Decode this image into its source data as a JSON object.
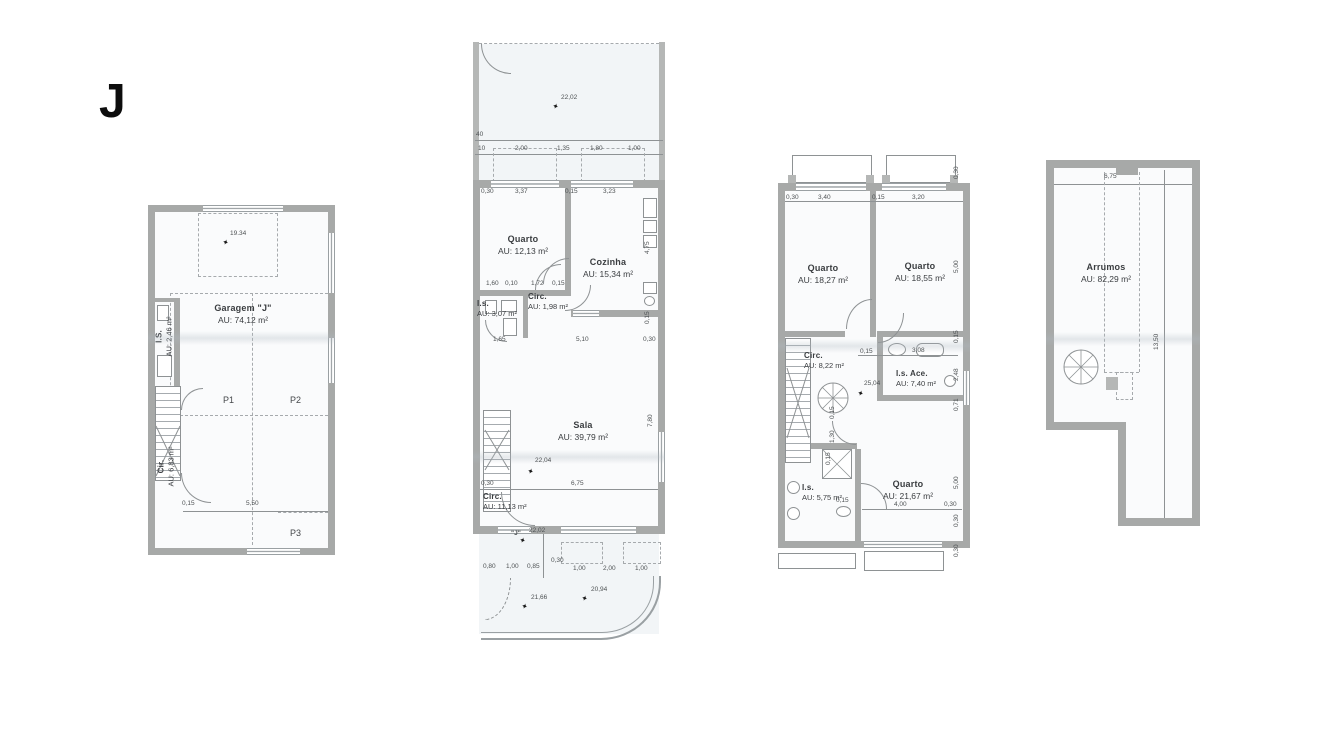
{
  "unit": {
    "letter": "J"
  },
  "garage": {
    "rooms": {
      "garagem": {
        "label": "Garagem \"J\"",
        "area": "AU: 74,12 m²"
      },
      "is": {
        "label": "I.S.",
        "area": "AU: 2,46 m²"
      },
      "cir": {
        "label": "Cir.",
        "area": "AU: 6,83 m²"
      }
    },
    "parking": {
      "p1": "P1",
      "p2": "P2",
      "p3": "P3"
    },
    "annotations": [
      {
        "t": "19.34",
        "x": 82,
        "y": 26
      },
      {
        "t": "0,15",
        "x": 34,
        "y": 296
      },
      {
        "t": "5,50",
        "x": 98,
        "y": 296
      }
    ],
    "markers": [
      {
        "x": 74,
        "y": 34
      }
    ]
  },
  "main_floor": {
    "rooms": {
      "quarto": {
        "label": "Quarto",
        "area": "AU: 12,13 m²"
      },
      "cozinha": {
        "label": "Cozinha",
        "area": "AU: 15,34 m²"
      },
      "is": {
        "label": "I.s.",
        "area": "AU: 3,07 m²"
      },
      "circ1": {
        "label": "Circ.",
        "area": "AU: 1,98 m²"
      },
      "sala": {
        "label": "Sala",
        "area": "AU: 39,79 m²"
      },
      "circ2": {
        "label": "Circ.",
        "area": "AU: 11,13 m²"
      }
    },
    "entry_label": "\"J\"",
    "annotations": [
      {
        "t": "22,02",
        "x": 88,
        "y": 53
      },
      {
        "t": "40",
        "x": 3,
        "y": 90
      },
      {
        "t": "10",
        "x": 5,
        "y": 104
      },
      {
        "t": "2,00",
        "x": 42,
        "y": 104
      },
      {
        "t": "1,35",
        "x": 84,
        "y": 104
      },
      {
        "t": "1,80",
        "x": 117,
        "y": 104
      },
      {
        "t": "1,00",
        "x": 155,
        "y": 104
      },
      {
        "t": "0,30",
        "x": 8,
        "y": 147
      },
      {
        "t": "3,37",
        "x": 42,
        "y": 147
      },
      {
        "t": "0,15",
        "x": 92,
        "y": 147
      },
      {
        "t": "3,23",
        "x": 130,
        "y": 147
      },
      {
        "t": "1,60",
        "x": 13,
        "y": 239
      },
      {
        "t": "0,10",
        "x": 32,
        "y": 239
      },
      {
        "t": "1,72",
        "x": 58,
        "y": 239
      },
      {
        "t": "0,15",
        "x": 79,
        "y": 239
      },
      {
        "t": "1,65",
        "x": 20,
        "y": 295
      },
      {
        "t": "5,10",
        "x": 103,
        "y": 295
      },
      {
        "t": "0,30",
        "x": 170,
        "y": 295
      },
      {
        "t": "4,75",
        "x": 172,
        "y": 212,
        "r": 1
      },
      {
        "t": "0,15",
        "x": 172,
        "y": 282,
        "r": 1
      },
      {
        "t": "7,80",
        "x": 175,
        "y": 385,
        "r": 1
      },
      {
        "t": "0,30",
        "x": 8,
        "y": 439
      },
      {
        "t": "6,75",
        "x": 98,
        "y": 439
      },
      {
        "t": "22,04",
        "x": 62,
        "y": 416
      },
      {
        "t": "22,02",
        "x": 56,
        "y": 486
      },
      {
        "t": "0,80",
        "x": 10,
        "y": 522
      },
      {
        "t": "1,00",
        "x": 33,
        "y": 522
      },
      {
        "t": "0,85",
        "x": 54,
        "y": 522
      },
      {
        "t": "0,30",
        "x": 78,
        "y": 516
      },
      {
        "t": "1,00",
        "x": 100,
        "y": 524
      },
      {
        "t": "2,00",
        "x": 130,
        "y": 524
      },
      {
        "t": "1,00",
        "x": 162,
        "y": 524
      },
      {
        "t": "21,66",
        "x": 58,
        "y": 553
      },
      {
        "t": "20,94",
        "x": 118,
        "y": 545
      }
    ],
    "markers": [
      {
        "x": 79,
        "y": 61
      },
      {
        "x": 54,
        "y": 426
      },
      {
        "x": 46,
        "y": 495
      },
      {
        "x": 48,
        "y": 561
      },
      {
        "x": 108,
        "y": 553
      }
    ]
  },
  "bedroom_floor": {
    "rooms": {
      "quarto1": {
        "label": "Quarto",
        "area": "AU: 18,27 m²"
      },
      "quarto2": {
        "label": "Quarto",
        "area": "AU: 18,55 m²"
      },
      "circ": {
        "label": "Circ.",
        "area": "AU: 8,22 m²"
      },
      "isace": {
        "label": "I.s. Ace.",
        "area": "AU: 7,40 m²"
      },
      "is": {
        "label": "I.s.",
        "area": "AU: 5,75 m²"
      },
      "quarto3": {
        "label": "Quarto",
        "area": "AU: 21,67 m²"
      }
    },
    "annotations": [
      {
        "t": "0,30",
        "x": 8,
        "y": 42
      },
      {
        "t": "3,40",
        "x": 40,
        "y": 42
      },
      {
        "t": "0,15",
        "x": 94,
        "y": 42
      },
      {
        "t": "3,20",
        "x": 134,
        "y": 42
      },
      {
        "t": "0,30",
        "x": 176,
        "y": 26,
        "r": 1
      },
      {
        "t": "5,00",
        "x": 176,
        "y": 120,
        "r": 1
      },
      {
        "t": "0,15",
        "x": 176,
        "y": 190,
        "r": 1
      },
      {
        "t": "2,48",
        "x": 176,
        "y": 228,
        "r": 1
      },
      {
        "t": "0,71",
        "x": 176,
        "y": 258,
        "r": 1
      },
      {
        "t": "5,00",
        "x": 176,
        "y": 336,
        "r": 1
      },
      {
        "t": "0,30",
        "x": 176,
        "y": 374,
        "r": 1
      },
      {
        "t": "0,30",
        "x": 176,
        "y": 404,
        "r": 1
      },
      {
        "t": "0,15",
        "x": 82,
        "y": 196
      },
      {
        "t": "3,08",
        "x": 134,
        "y": 195
      },
      {
        "t": "25,04",
        "x": 86,
        "y": 228
      },
      {
        "t": "0,15",
        "x": 52,
        "y": 266,
        "r": 1
      },
      {
        "t": "1,30",
        "x": 52,
        "y": 290,
        "r": 1
      },
      {
        "t": "0,15",
        "x": 48,
        "y": 312,
        "r": 1
      },
      {
        "t": "0,15",
        "x": 58,
        "y": 345
      },
      {
        "t": "4,00",
        "x": 116,
        "y": 349
      },
      {
        "t": "0,30",
        "x": 166,
        "y": 349
      }
    ],
    "markers": [
      {
        "x": 79,
        "y": 237
      }
    ]
  },
  "attic": {
    "rooms": {
      "arrumos": {
        "label": "Arrumos",
        "area": "AU: 82,29 m²"
      }
    },
    "annotations": [
      {
        "t": "6,75",
        "x": 58,
        "y": 14
      },
      {
        "t": "13,50",
        "x": 108,
        "y": 190,
        "r": 1
      }
    ],
    "markers": []
  }
}
